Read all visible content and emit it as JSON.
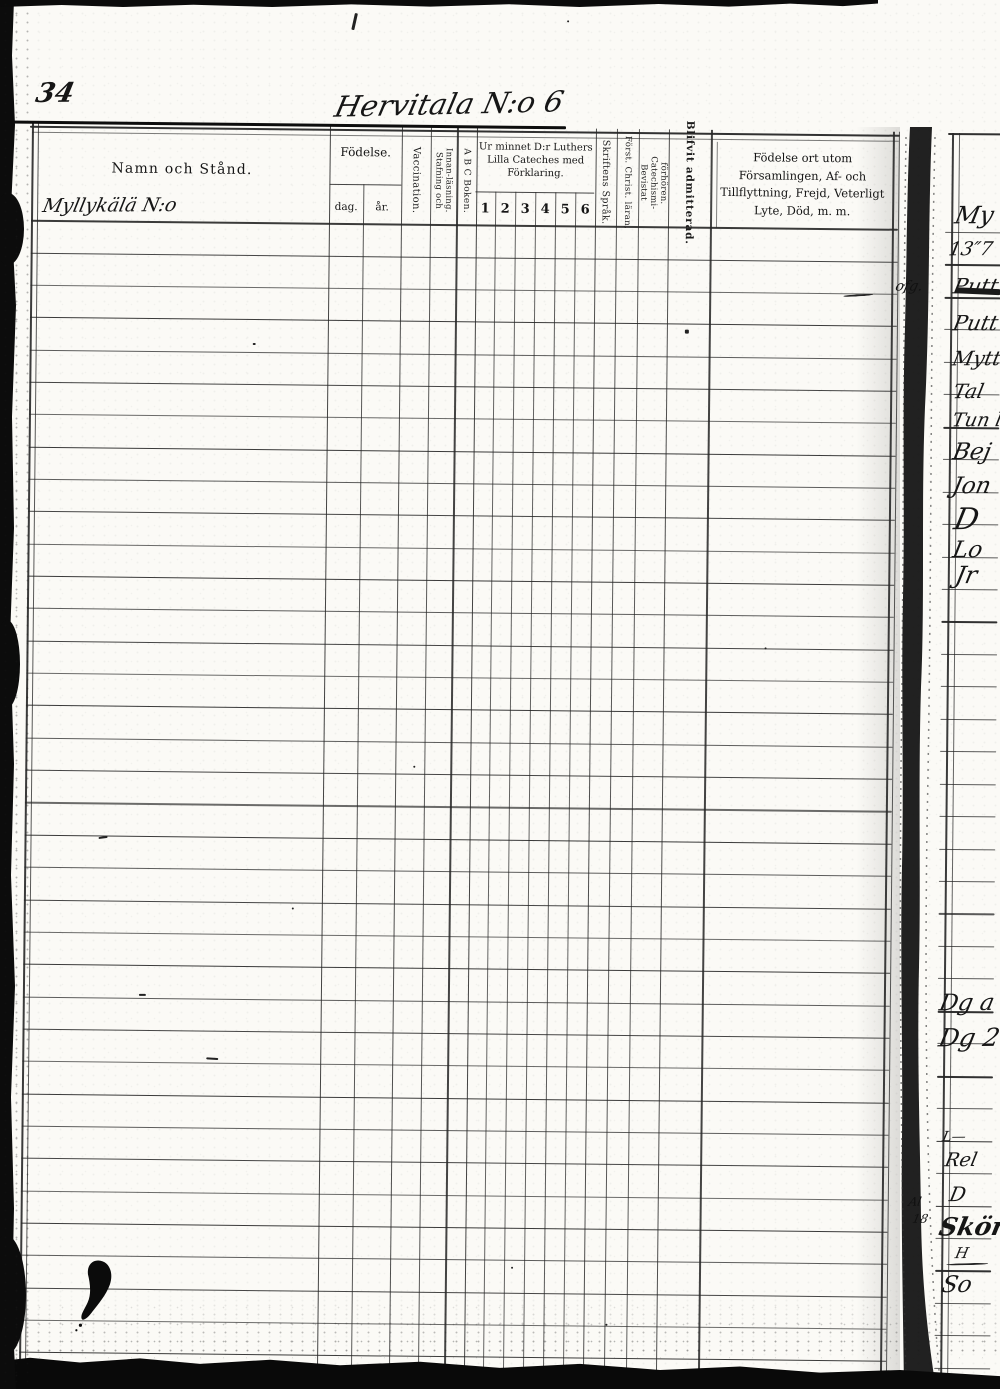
{
  "page": {
    "folio_number": "34",
    "title": "Hervitala N:o 6"
  },
  "table": {
    "headers": {
      "name": "Namn och Stånd.",
      "birth": "Födelse.",
      "birth_day": "dag.",
      "birth_year": "år.",
      "vaccination": "Vaccination.",
      "spelling_reading": "Stafning och Innan-läsning.",
      "abc_book": "A B C Boken.",
      "catechism": "Ur minnet D:r Luthers Lilla Cateches med Förklaring.",
      "scripture_language": "Skriftens Språk.",
      "understands_doctrine": "Först. Christ. läran,",
      "attended_examinations": "Bevistat Catechismi-förhören.",
      "admitted": "Blifvit admitterad.",
      "notes": "Födelse ort utom Församlingen, Af- och Tillflyttning, Frejd, Veterligt Lyte, Död, m. m."
    },
    "catechism_grades": [
      "1",
      "2",
      "3",
      "4",
      "5",
      "6"
    ],
    "name_entry_handwritten": "Myllykälä N:o",
    "row_count": 35
  },
  "right_page": {
    "fragments": [
      {
        "y": 203,
        "x": 956,
        "text": "My",
        "size": 24
      },
      {
        "y": 240,
        "x": 950,
        "text": "13″7",
        "size": 19
      },
      {
        "y": 276,
        "x": 955,
        "text": "Putt",
        "size": 21
      },
      {
        "y": 313,
        "x": 955,
        "text": "Putt",
        "size": 21
      },
      {
        "y": 348,
        "x": 955,
        "text": "Mytt",
        "size": 20
      },
      {
        "y": 381,
        "x": 956,
        "text": "Tal",
        "size": 20
      },
      {
        "y": 411,
        "x": 955,
        "text": "Tun l",
        "size": 19
      },
      {
        "y": 441,
        "x": 956,
        "text": "Bej",
        "size": 23
      },
      {
        "y": 475,
        "x": 956,
        "text": "Jon",
        "size": 23
      },
      {
        "y": 505,
        "x": 958,
        "text": "D",
        "size": 30
      },
      {
        "y": 539,
        "x": 957,
        "text": "Lo",
        "size": 23
      },
      {
        "y": 563,
        "x": 960,
        "text": "Jr",
        "size": 24
      },
      {
        "y": 992,
        "x": 948,
        "text": "Dg a",
        "size": 23
      },
      {
        "y": 1025,
        "x": 948,
        "text": "Dg 2",
        "size": 25
      },
      {
        "y": 1130,
        "x": 952,
        "text": "L—",
        "size": 14
      },
      {
        "y": 1151,
        "x": 955,
        "text": "Rel",
        "size": 19
      },
      {
        "y": 1184,
        "x": 960,
        "text": "D",
        "size": 20
      },
      {
        "y": 1214,
        "x": 950,
        "text": "Skör",
        "size": 25,
        "bold": true
      },
      {
        "y": 1246,
        "x": 966,
        "text": "H",
        "size": 15
      },
      {
        "y": 1274,
        "x": 953,
        "text": "So",
        "size": 23
      }
    ],
    "gutter_notes": [
      {
        "x": 897,
        "y": 280,
        "text": "ofg.",
        "size": 14
      },
      {
        "x": 919,
        "y": 1196,
        "text": "Al",
        "size": 12
      },
      {
        "x": 923,
        "y": 1213,
        "text": "18",
        "size": 12
      }
    ]
  }
}
